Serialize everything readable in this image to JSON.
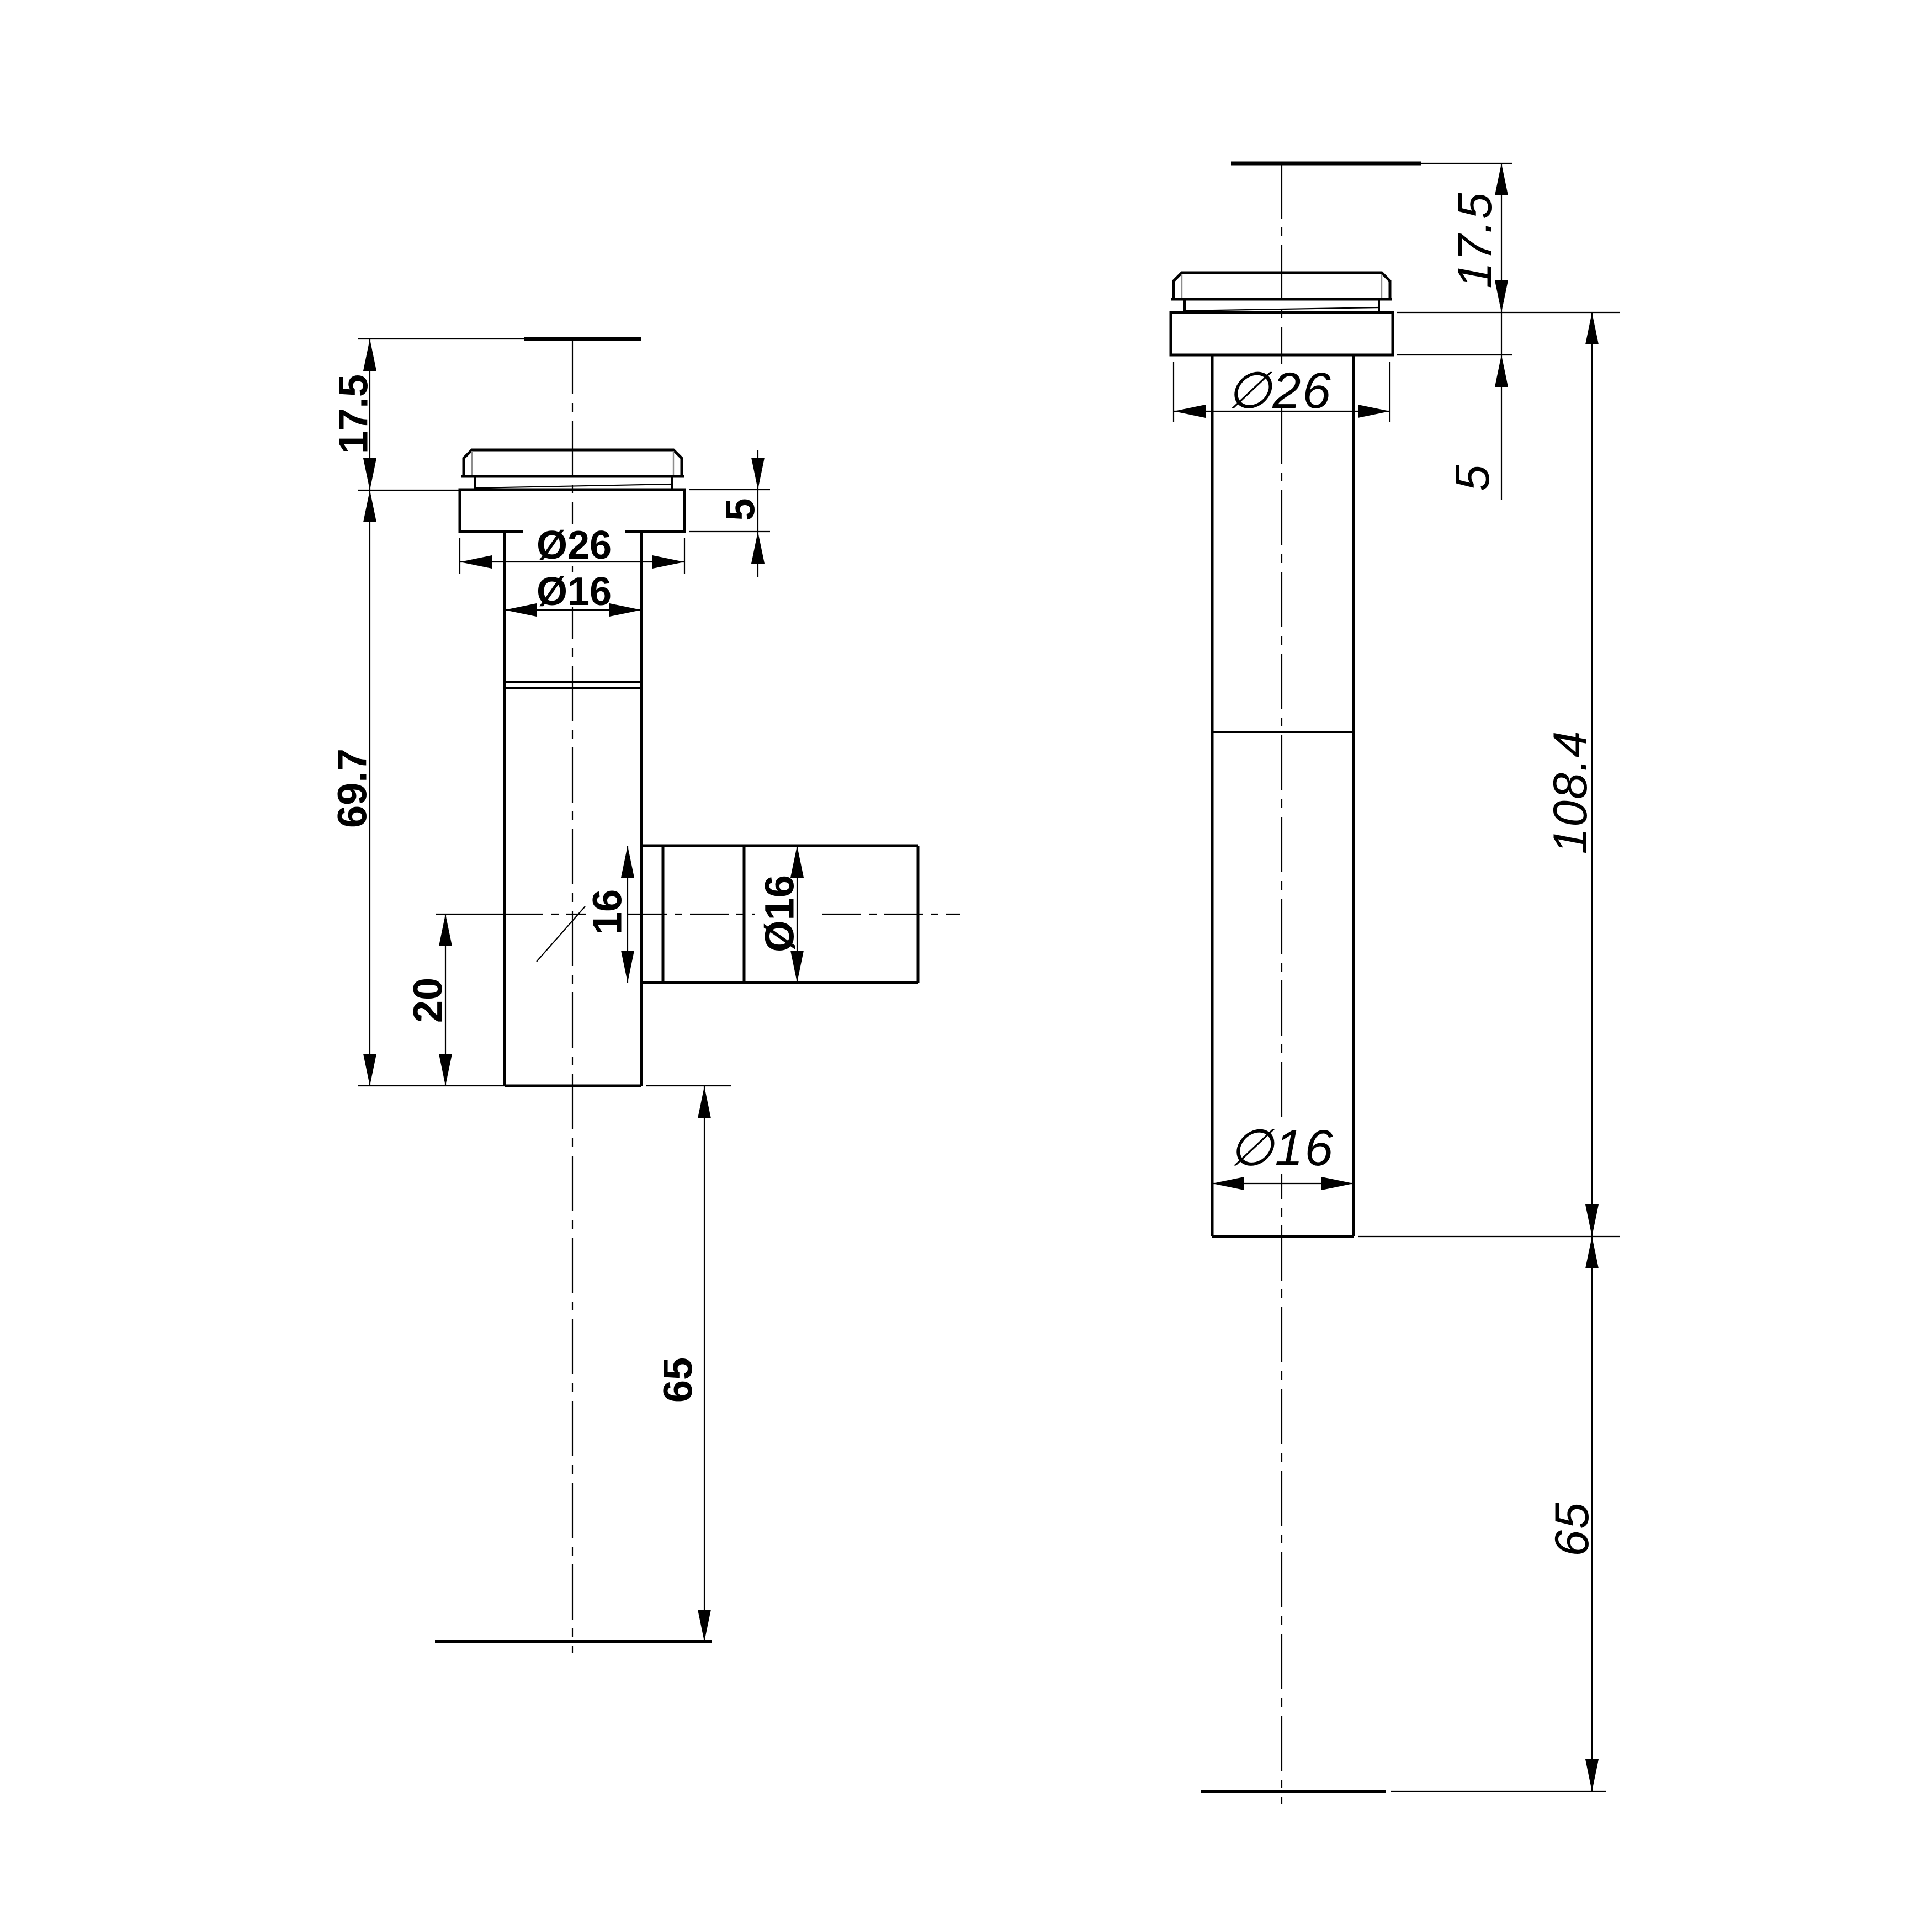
{
  "drawing": {
    "background": "#ffffff",
    "line_color": "#000000",
    "left_view": {
      "labels": {
        "height_cap": "17.5",
        "slab_thickness": "5",
        "dia_outer": "Ø26",
        "dia_shaft": "Ø16",
        "length_body": "69.7",
        "offset_branch": "20",
        "branch_bore": "16",
        "branch_dia": "Ø16",
        "length_tail": "65"
      }
    },
    "right_view": {
      "labels": {
        "height_cap": "17.5",
        "slab_thickness": "5",
        "dia_outer": "∅26",
        "dia_tube": "∅16",
        "length_body": "108.4",
        "length_tail": "65"
      }
    }
  }
}
